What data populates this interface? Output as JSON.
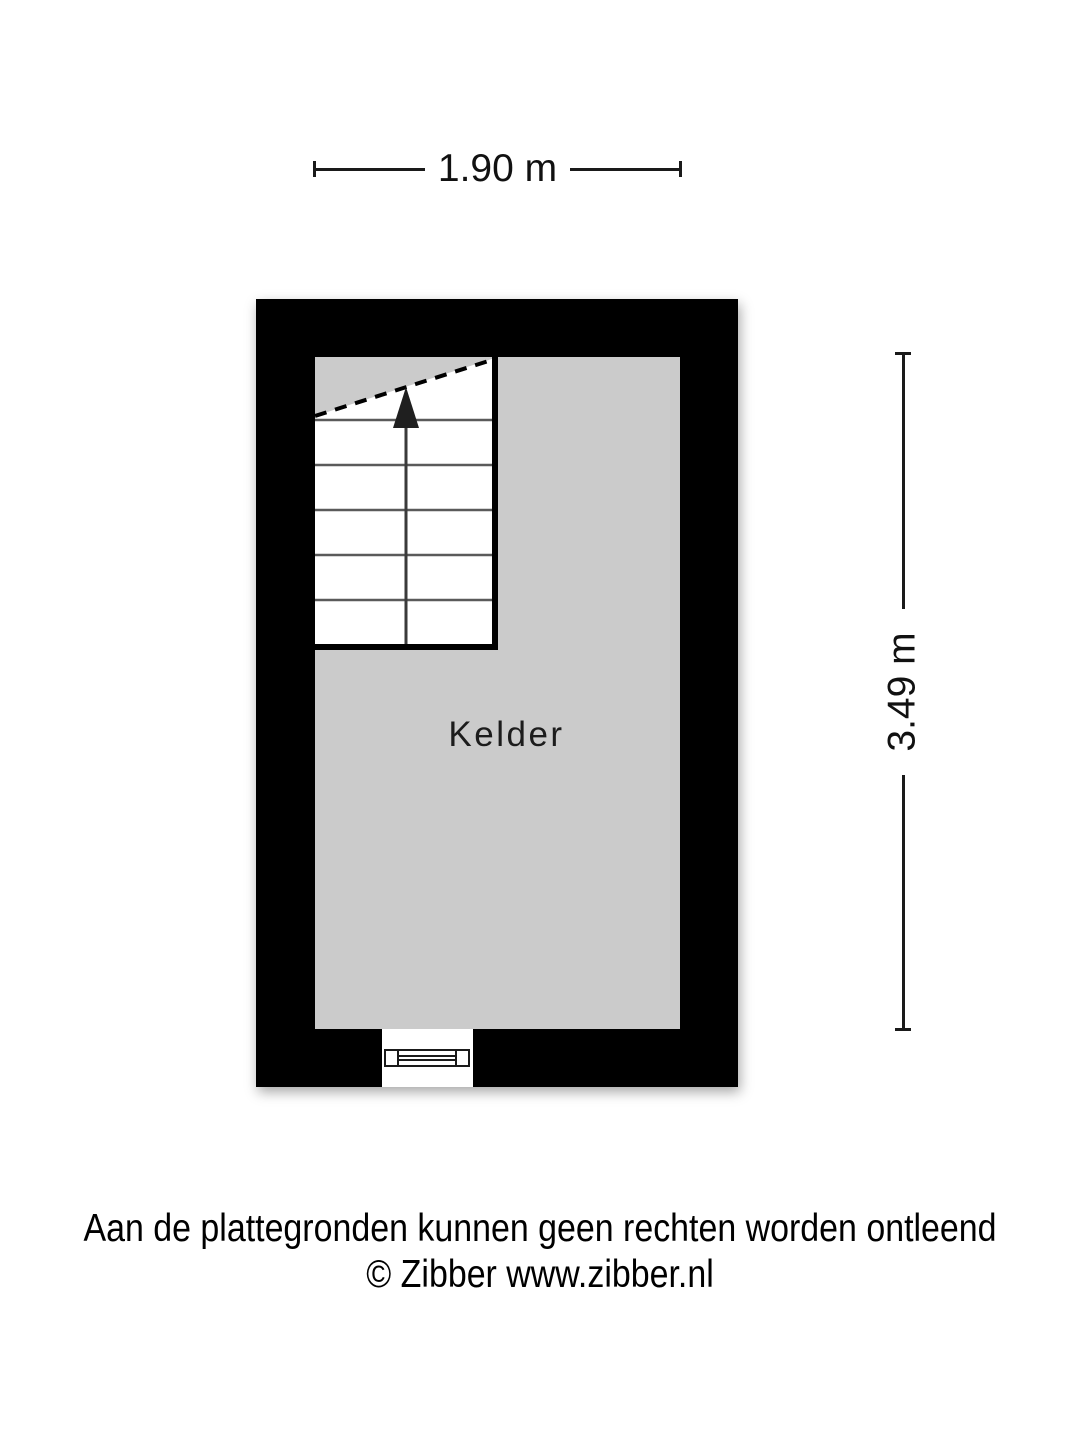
{
  "floorplan": {
    "room": {
      "label": "Kelder",
      "type": "basement"
    },
    "dimensions": {
      "width_label": "1.90 m",
      "height_label": "3.49 m"
    },
    "stairs": {
      "tread_rows": 6,
      "direction": "up",
      "direction_icon": "up-arrow"
    },
    "colors": {
      "wall": "#000000",
      "floor": "#cbcbcb",
      "dim": "#1a1a1a"
    }
  },
  "footer": {
    "disclaimer": "Aan de plattegronden kunnen geen rechten worden ontleend",
    "copyright": "© Zibber www.zibber.nl"
  }
}
